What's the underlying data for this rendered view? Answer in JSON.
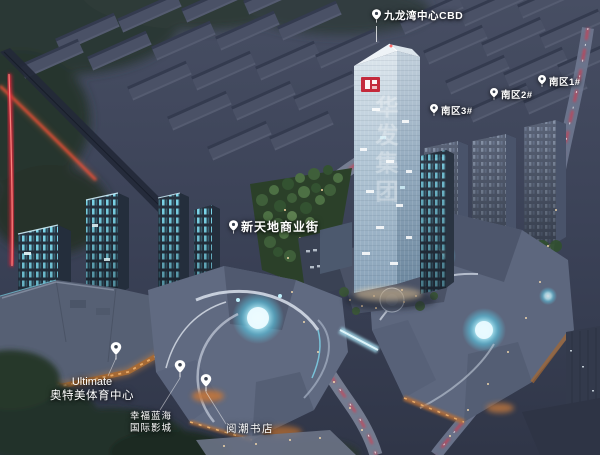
{
  "scene": {
    "type": "aerial-architectural-rendering-night",
    "project_label": "九龙湾中心CBD",
    "district_labels": [
      {
        "label": "南区1#"
      },
      {
        "label": "南区2#"
      },
      {
        "label": "南区3#"
      }
    ],
    "street_label": "新天地商业街",
    "venues": {
      "sports_center": {
        "line1": "Ultimate",
        "line2": "奥特美体育中心"
      },
      "cinema": {
        "line1": "幸福蓝海",
        "line2": "国际影城"
      },
      "bookstore": "阅潮书店"
    },
    "tower_sign": "华发集团",
    "icons": {
      "pin": "location-pin-icon"
    },
    "colors": {
      "label_text": "#ffffff",
      "logo_red": "#c42a3c",
      "tail_light_red": "#e2394b",
      "window_cyan": "#7edaee",
      "wood_orange": "#c3763a",
      "night_base": "#3a4156"
    }
  }
}
